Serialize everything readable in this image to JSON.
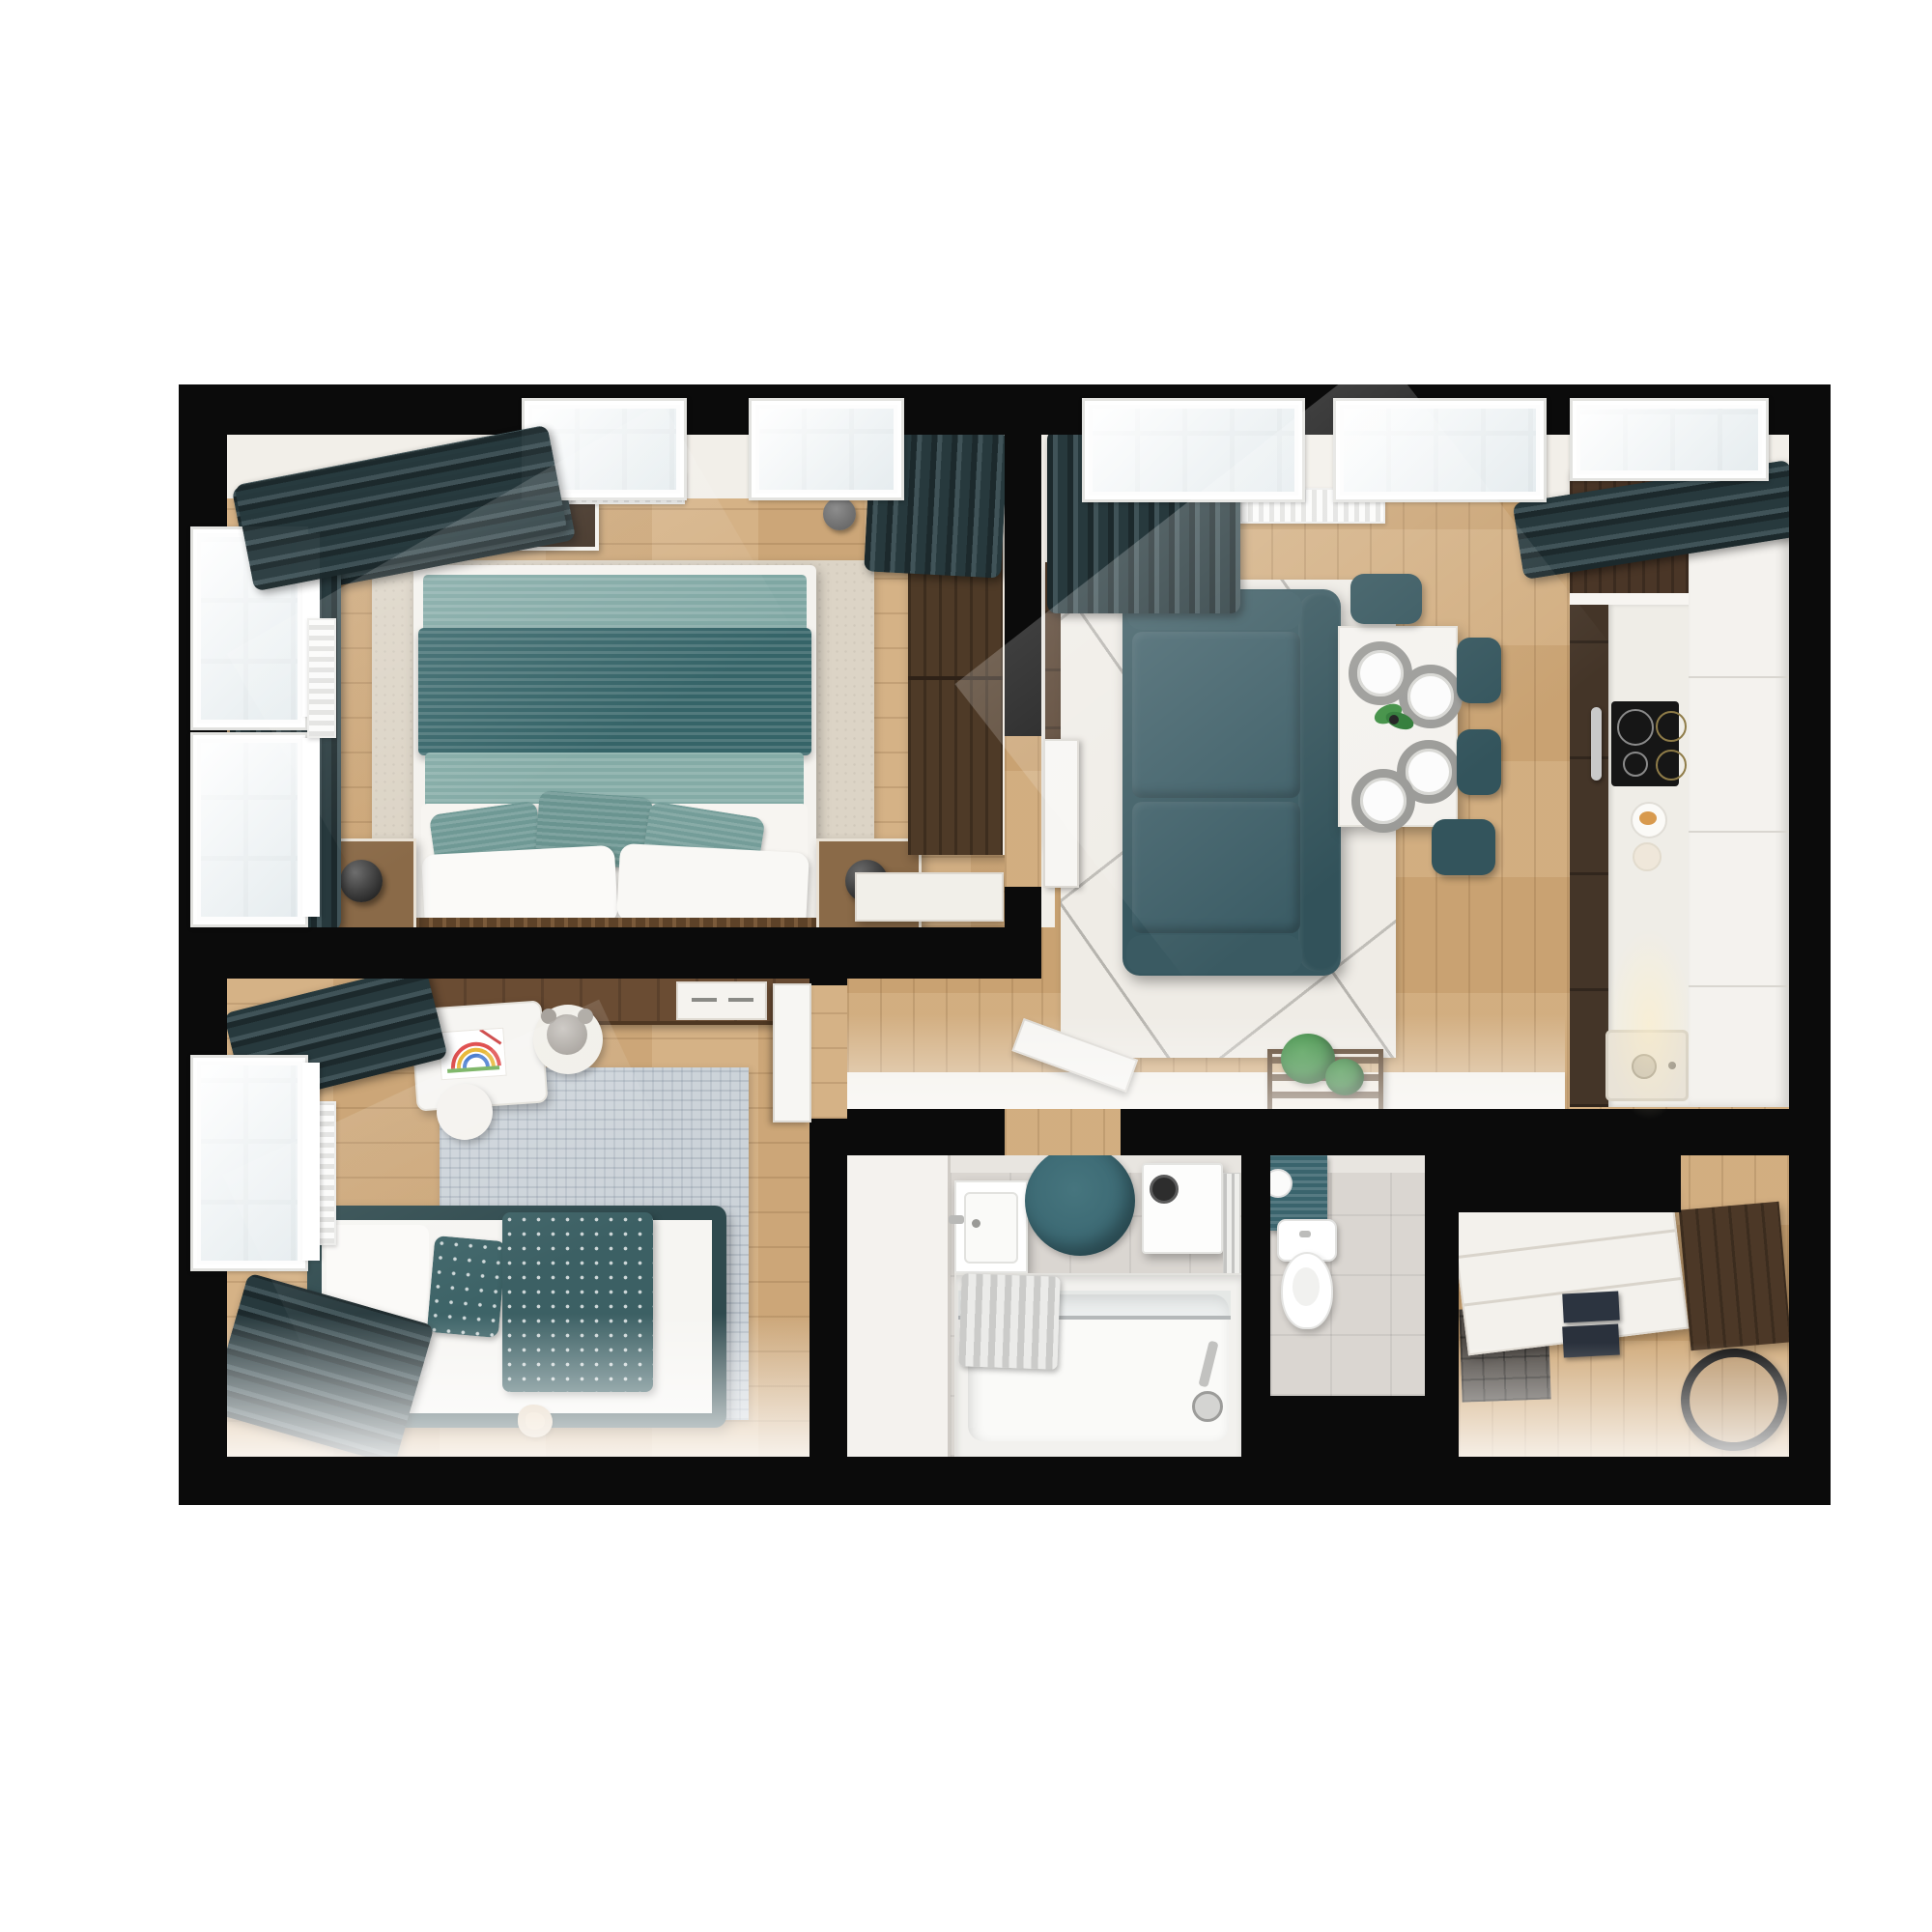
{
  "scene": {
    "kind": "3d-floor-plan-top-down-render",
    "background_color": "#ffffff",
    "wall_color": "#0b0b0b",
    "palette": {
      "wood_floor": "#d0aa7b",
      "dark_wood_furniture": "#4a3627",
      "teal_textile": "#3a5f66",
      "curtain_teal": "#2d4247",
      "bathroom_tile": "#dad6d1",
      "living_rug": "#efece6",
      "bedroom_rug": "#dcd4c6",
      "kids_rug": "#ccd3d9",
      "accent_round_rug": "#3e6a72"
    },
    "rooms": {
      "master_bedroom": {
        "label": "Master bedroom",
        "furniture": [
          "double bed with layered teal blankets",
          "white and teal pillows",
          "beige area rug",
          "two wooden nightstands",
          "black sphere lamps",
          "dark wardrobe",
          "white console",
          "recessed ceiling lamp",
          "radiator",
          "dark teal curtains",
          "white framed windows"
        ]
      },
      "living_room": {
        "label": "Living room",
        "furniture": [
          "dark teal sofa",
          "white rug with gray line pattern",
          "dark wood TV sideboard",
          "gray round pouf",
          "white dining table",
          "four gray place settings",
          "green centerpiece plant",
          "four dark teal chairs",
          "radiator",
          "dark teal curtains",
          "windows"
        ]
      },
      "kitchen": {
        "label": "Kitchen",
        "furniture": [
          "dark wood cabinet run",
          "white countertop",
          "induction cooktop with four rings",
          "oven with chrome handle",
          "sink with drain",
          "tall white cabinet column",
          "breakfast plate"
        ]
      },
      "kids_room": {
        "label": "Kids room",
        "furniture": [
          "single bed with dotted teal duvet",
          "teal canopy frame",
          "light blue-gray rug",
          "wall desk",
          "white kids table with rainbow drawing",
          "teddy bear on chair",
          "white stool",
          "vertical radiator",
          "dark teal curtains",
          "window",
          "toy on floor"
        ]
      },
      "hallway": {
        "label": "Hallway",
        "furniture": [
          "open white doors",
          "wooden plant stand with green plants"
        ]
      },
      "bathroom": {
        "label": "Bathroom",
        "furniture": [
          "bathtub with glass screen",
          "hanging striped towels",
          "shower fittings",
          "white sink cabinet",
          "teal round rug",
          "washing machine",
          "towel rail"
        ]
      },
      "wc": {
        "label": "WC",
        "furniture": [
          "toilet",
          "teal mat",
          "paper roll"
        ]
      },
      "entry_hall": {
        "label": "Entry hall",
        "furniture": [
          "white drawer sideboard",
          "dark wood wardrobe",
          "black oval mirror",
          "dark gray doormat",
          "navy storage boxes"
        ]
      }
    }
  }
}
